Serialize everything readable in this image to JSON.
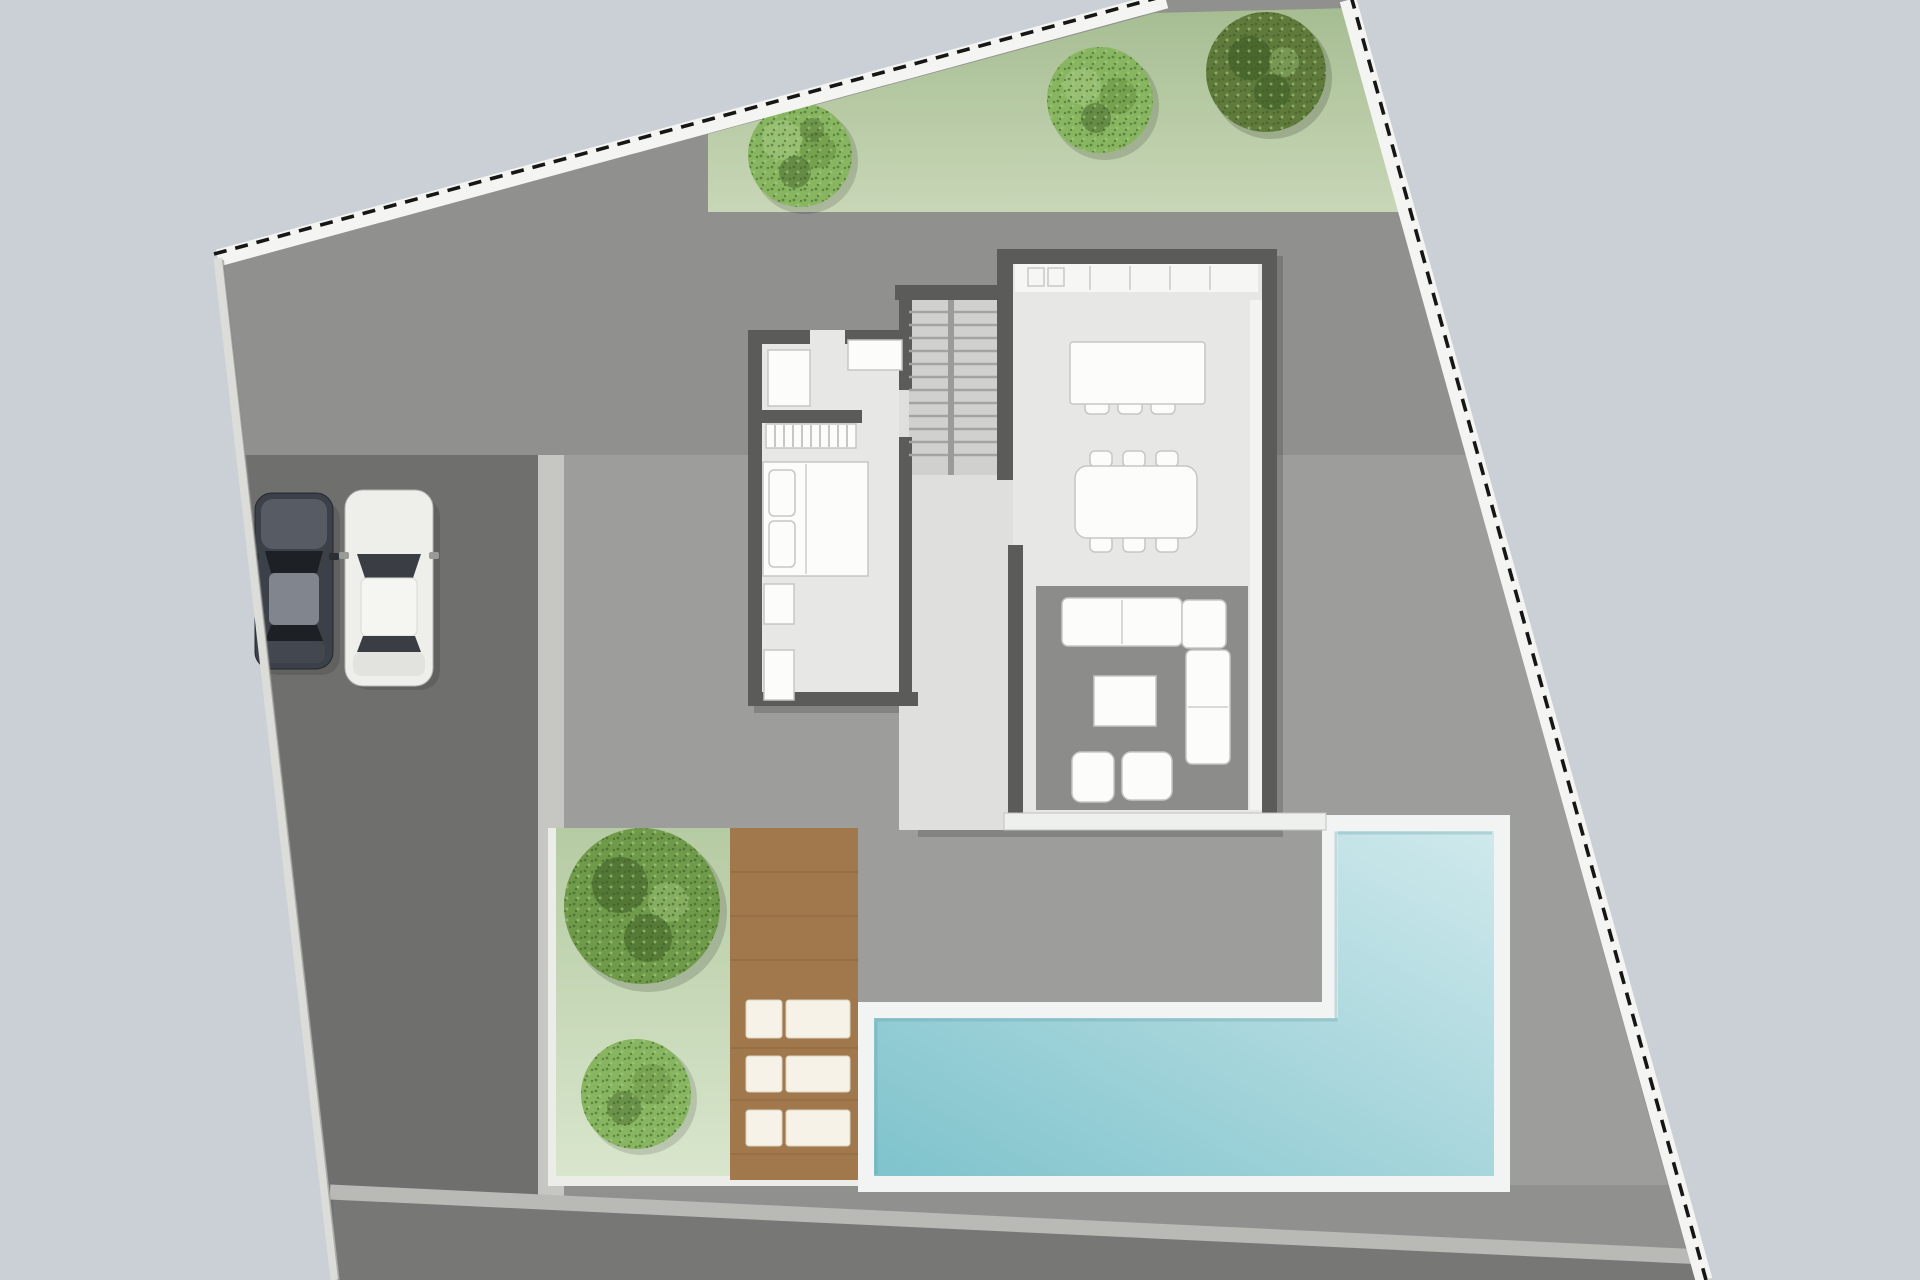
{
  "scene": {
    "type": "architectural-site-plan",
    "view": "top-down ground floor plan of a villa plot",
    "visible_text": "none",
    "objects": [
      {
        "id": "site-boundary",
        "label": "irregular parcel boundary with dashed survey line on white band"
      },
      {
        "id": "lawn-strip",
        "label": "lawn strip along north boundary",
        "planting_count": 3
      },
      {
        "id": "shrub-north-1",
        "label": "light green shrub"
      },
      {
        "id": "shrub-north-2",
        "label": "light green shrub"
      },
      {
        "id": "tree-north",
        "label": "dark olive tree"
      },
      {
        "id": "driveway",
        "label": "dark asphalt driveway"
      },
      {
        "id": "walkway-divider",
        "label": "light walkway strip between driveway and terrace"
      },
      {
        "id": "car-dark",
        "label": "dark sedan parked facing north"
      },
      {
        "id": "car-white",
        "label": "white sedan parked facing north"
      },
      {
        "id": "house",
        "label": "single storey house"
      },
      {
        "id": "bedroom",
        "label": "bedroom with double bed, two pillows, wardrobe, dressers, nightstands"
      },
      {
        "id": "staircase",
        "label": "double-flight staircase",
        "tread_count": 12
      },
      {
        "id": "kitchen",
        "label": "kitchen with wall counter and island",
        "bar_stool_count": 3
      },
      {
        "id": "dining",
        "label": "dining table",
        "chair_count": 6
      },
      {
        "id": "living",
        "label": "living room with rug, L-shaped sofa, coffee table",
        "pouf_count": 2
      },
      {
        "id": "window-wall",
        "label": "full-height glazing along east wall"
      },
      {
        "id": "terrace-edge",
        "label": "white terrace threshold at south side of house"
      },
      {
        "id": "garden",
        "label": "south-west lawn patch with one large tree and one shrub"
      },
      {
        "id": "deck",
        "label": "timber sun deck",
        "sun_lounger_count": 3
      },
      {
        "id": "pool",
        "label": "L-shaped swimming pool with white coping"
      }
    ]
  },
  "colors": {
    "background": "#cbd0d6",
    "band_white": "#f4f4f2",
    "dash_black": "#161616",
    "left_band": "#dcdcd8",
    "plot_gray": "#90918f",
    "terrace_gray": "#9d9e9b",
    "driveway_gray": "#6f706e",
    "south_dark": "#777876",
    "south_band": "#b9b9b6",
    "divider_light": "#c6c6c2",
    "grass_a": "#a6bd92",
    "grass_b": "#c8d7b7",
    "garden_a": "#b5cba3",
    "garden_b": "#d9e6cd",
    "garden_edge": "#ecece8",
    "bush_light": "#87b560",
    "bush_mid": "#6f9a49",
    "tree_dark_base": "#5f7a3b",
    "speck_dark": "#3c5c26",
    "speck_lite": "#a8cc84",
    "deck_brown": "#a1784c",
    "deck_line": "#7d5c39",
    "lounger_white": "#f6f2e7",
    "pool_coping": "#f1f4f2",
    "water_deep": "#7fc3cc",
    "water_light": "#cfe9ec",
    "wall_dark": "#5b5c5a",
    "floor_light": "#e7e7e5",
    "floor_mid": "#dfdfdd",
    "stair_floor": "#d0d0ce",
    "tread_line": "#a3a3a1",
    "rug_gray": "#8c8d8a",
    "furn_white": "#fcfcfa",
    "furn_stroke": "#c6c6c3",
    "window_white": "#f3f3f1",
    "counter_white": "#f6f6f4",
    "car_dark_body": "#3c4048",
    "car_dark_hood": "#565b64",
    "car_dark_roof": "#81868e",
    "glass_dark": "#1d2025",
    "car_white_body": "#eeeeea",
    "car_white_glass": "#3a3e44"
  }
}
